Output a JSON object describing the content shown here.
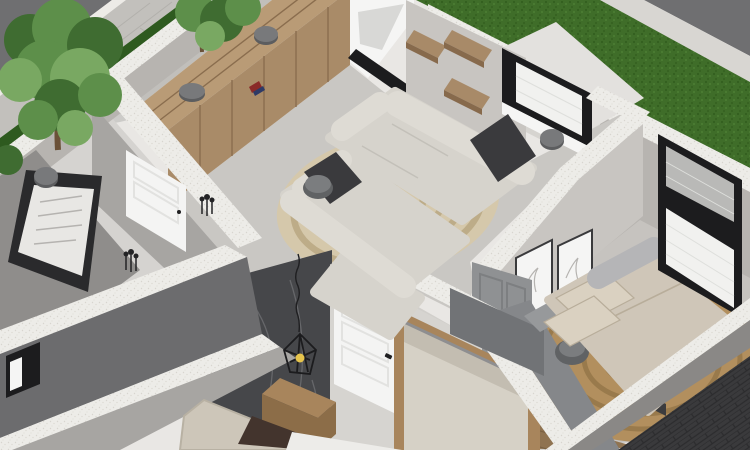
{
  "scene": {
    "type": "3d-floorplan-render",
    "view": "isometric-dollhouse-cutaway",
    "rooms": [
      {
        "id": "exterior-street",
        "label": "street with sidewalk and trees"
      },
      {
        "id": "exterior-lawn",
        "label": "grass lawn strip"
      },
      {
        "id": "office-room",
        "label": "room with wall board"
      },
      {
        "id": "living-room",
        "label": "living room with sofas and wardrobe"
      },
      {
        "id": "utility-room",
        "label": "small top-right room with window"
      },
      {
        "id": "bedroom-main",
        "label": "right bedroom with double bed"
      },
      {
        "id": "bedroom-second",
        "label": "bottom bedroom with marble accent wall"
      }
    ],
    "objects": [
      {
        "name": "tree",
        "room": "exterior-street"
      },
      {
        "name": "hedge-strip",
        "room": "exterior-street"
      },
      {
        "name": "wardrobe-cabinet",
        "room": "living-room"
      },
      {
        "name": "ceiling-spot-lamp",
        "room": "living-room"
      },
      {
        "name": "wall-shelves",
        "room": "living-room"
      },
      {
        "name": "sofa-upper",
        "room": "living-room"
      },
      {
        "name": "sofa-lower",
        "room": "living-room"
      },
      {
        "name": "spiral-rug",
        "room": "living-room"
      },
      {
        "name": "round-side-table",
        "room": "living-room"
      },
      {
        "name": "wall-board",
        "room": "office-room"
      },
      {
        "name": "white-door",
        "room": "office-room"
      },
      {
        "name": "floor-plants",
        "room": "office-room"
      },
      {
        "name": "window-black-frame",
        "room": "utility-room"
      },
      {
        "name": "double-bed",
        "room": "bedroom-main"
      },
      {
        "name": "picture-frames",
        "room": "bedroom-main"
      },
      {
        "name": "jute-round-rug",
        "room": "bedroom-main"
      },
      {
        "name": "gray-door",
        "room": "bedroom-main"
      },
      {
        "name": "dresser",
        "room": "bedroom-main"
      },
      {
        "name": "round-stool",
        "room": "bedroom-main"
      },
      {
        "name": "bedroom-window",
        "room": "bedroom-main"
      },
      {
        "name": "marble-accent-wall",
        "room": "bedroom-second"
      },
      {
        "name": "bed-headboard",
        "room": "bedroom-second"
      },
      {
        "name": "nightstand",
        "room": "bedroom-second"
      },
      {
        "name": "pendant-cage-lamp",
        "room": "bedroom-second"
      },
      {
        "name": "white-door-bedroom",
        "room": "bedroom-second"
      },
      {
        "name": "mirror-wardrobe",
        "room": "bedroom-second"
      }
    ]
  },
  "colors": {
    "road": "#6f6f71",
    "roadBrick": "#3a3a3c",
    "roadBrickLine": "#2c2c2e",
    "sidewalk": "#c2c0bc",
    "paverLine": "#b2b0ac",
    "curb": "#edebe7",
    "hedge": "#2e5a1f",
    "grass": "#3f6d29",
    "grassDark": "#315c1d",
    "grassLight": "#4c7e33",
    "band": "#edece8",
    "bandDot": "#d8d5cf",
    "marbleStrip": "#d8d6d2",
    "wallLight": "#d6d4d0",
    "wallLight2": "#c8c5c1",
    "wallMid": "#b7b4b0",
    "wallGray": "#a7a5a2",
    "wallDark": "#8f8d8b",
    "faceOuter": "#6c6c6e",
    "faceOuter2": "#8a8886",
    "floorA": "#d5d3d0",
    "floorB": "#c9c7c3",
    "floorC": "#e3e1de",
    "floorD": "#c6c3bf",
    "floorE": "#d1cfcb",
    "hallFloor": "#c1bfbb",
    "woodTop": "#b99b76",
    "woodFront": "#a98b68",
    "woodSeam": "#8a6d4e",
    "woodShelf": "#a88a68",
    "woodShelfSide": "#876a4c",
    "woodNight": "#a8855c",
    "woodNightSide": "#8c6d48",
    "woodFloor": "#8f7351",
    "woodFloorLine": "#7a6143",
    "marbleWall": "#46474a",
    "marbleVein": "#a2a3a6",
    "sofa": "#d6d3cc",
    "sofaBack": "#dedbd4",
    "sofaLine": "#c3c0b9",
    "cushionDark": "#3a3a3d",
    "rugBase": "#d5c8ab",
    "rugRing": "#bdac88",
    "rugJute": "#b28f5e",
    "rugJuteRing": "#997a4c",
    "linen": "#cfc6b8",
    "pillowBeige": "#dad1c1",
    "bolster": "#b5b5b7",
    "bedFrame": "#97999b",
    "legDark": "#3c3c3e",
    "stool": "#606264",
    "stoolTop": "#7b7d7f",
    "doorWhite": "#f4f4f3",
    "doorPanel": "#e2e2e0",
    "doorGray": "#8f9193",
    "doorGrayPanel": "#7d7f81",
    "handle": "#1f1f21",
    "frameBlack": "#1c1c1e",
    "brickWhite": "#f1f1ef",
    "brickLine": "#dedfdc",
    "glassGray": "#b9b9b7",
    "white": "#f5f5f4",
    "innerShade": "#d8d8d6",
    "mirror": "#d6d1c6",
    "mirrorTop": "#c3bdb1",
    "mirrorFrame": "#8e8e90",
    "headboard": "#cdc6b9",
    "pillowBrown": "#43342d",
    "duvet": "#edece9",
    "lamp": "#78797b",
    "lampRim": "#5c5d5f",
    "bulb": "#e6c44c",
    "trunk": "#6b5138",
    "green1": "#5d8f4a",
    "green2": "#3f6c31",
    "green3": "#79a862",
    "plant": "#232325",
    "redBook": "#8a2a28",
    "blueBook": "#2e3a66",
    "dresser": "#717376",
    "bench": "#85878a",
    "boardFrame": "#2a2a2c",
    "boardFace": "#e8e7e4",
    "boardLine": "#b5b3b0",
    "shadow": "#000000"
  }
}
